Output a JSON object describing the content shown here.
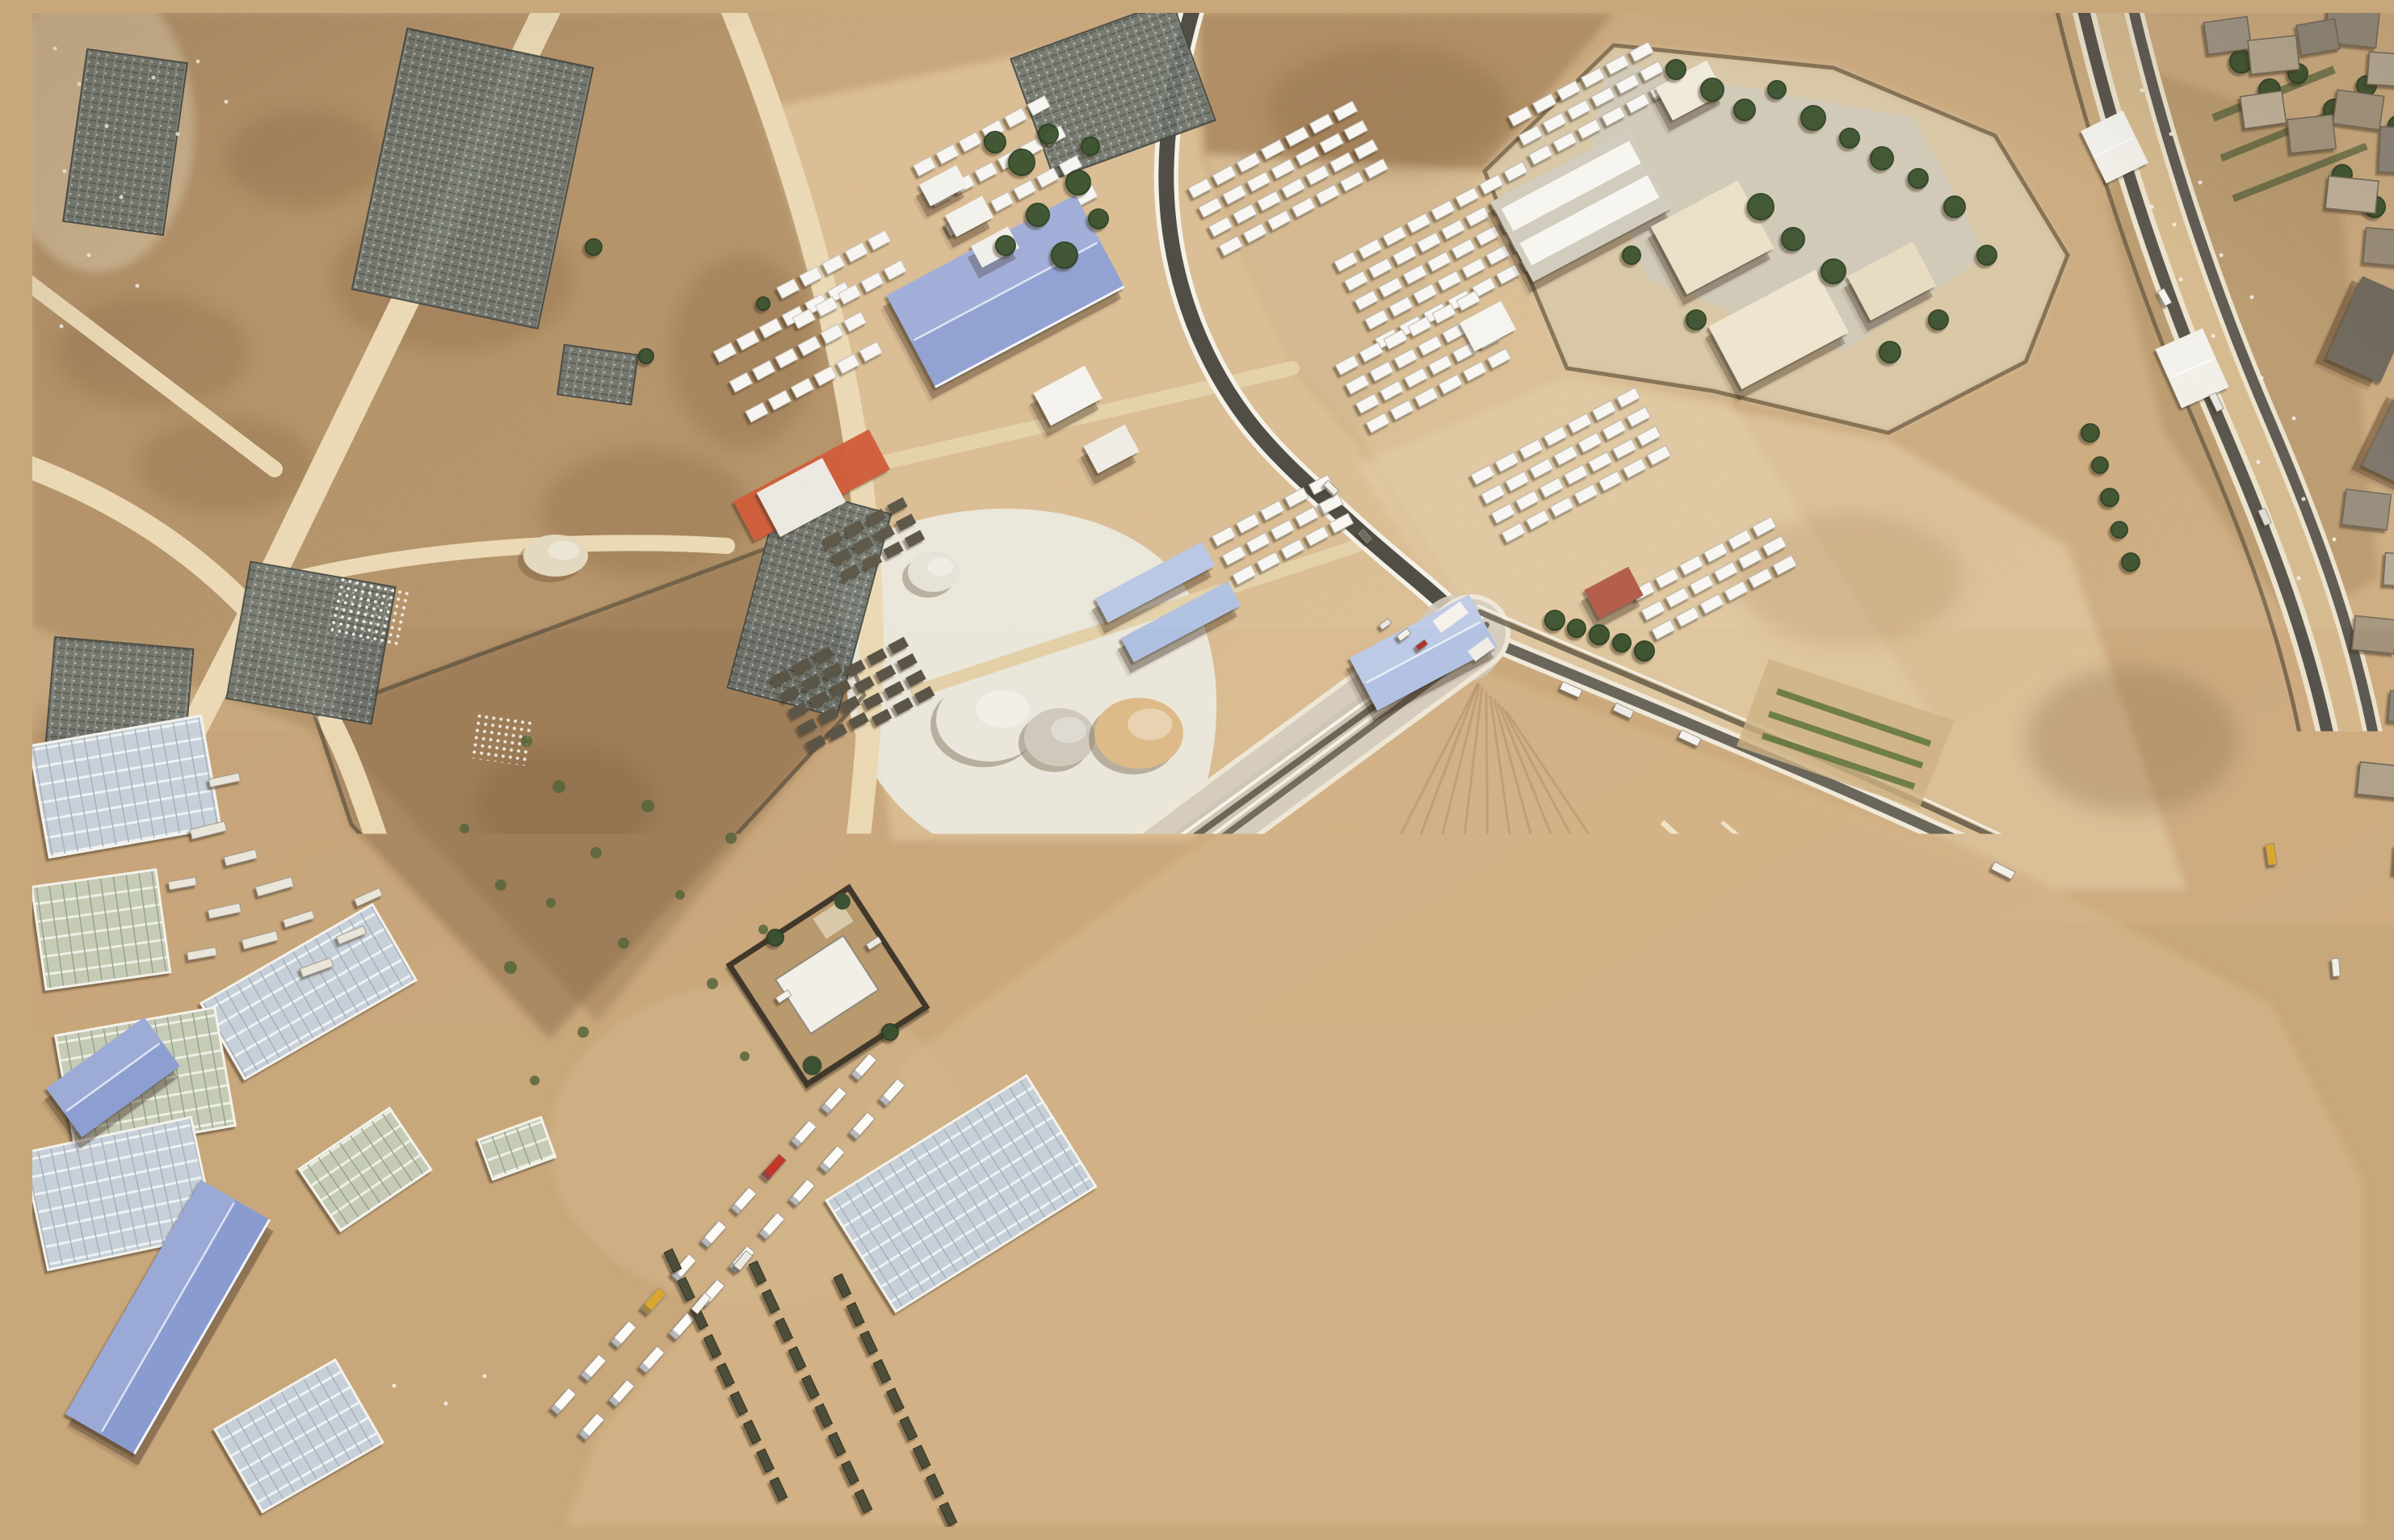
{
  "meta": {
    "type": "satellite-aerial-photograph",
    "description": "Overhead satellite view of a desert border-crossing area: a walled logistics compound with tent rows and warehouses, a long queue of aid trucks on a walled road, a crossing facility with trees, a double border road beside a town strip, greenhouses, and terraced earthworks."
  },
  "palette": {
    "sand_base": "#c9a87c",
    "sand_light": "#dcc096",
    "sand_pale": "#e9d9b8",
    "scrub_brown": "#9d7c57",
    "field_dark": "#8a6a49",
    "road_sand": "#ead8b2",
    "asphalt": "#4d4a43",
    "white_line": "#f4f1e8",
    "gravel": "#ece9e0",
    "roof_white": "#f5f4f0",
    "blue_roof": "#8d9ed1",
    "blue_glass": "#b7c6e4",
    "tree_green": "#3a5130",
    "red_tarp": "#d05a38",
    "truck_white": "#fbfaf7",
    "olive_vehicle": "#4e4e3a",
    "pad_gray": "#b5b0a5"
  },
  "scene": {
    "buildings": [
      [
        "blue-warehouse-main",
        1205,
        345,
        265,
        130,
        -28,
        "#8d9ed1",
        "srh"
      ],
      [
        "blue-shed-a",
        1390,
        705,
        150,
        34,
        -28,
        "#b7c6e4",
        "s"
      ],
      [
        "blue-shed-b",
        1422,
        754,
        150,
        34,
        -28,
        "#aebfe0",
        "s"
      ],
      [
        "blue-shed-east",
        1722,
        792,
        168,
        74,
        -28,
        "#b3c2e2",
        "sr"
      ],
      [
        "blue-building-small-sw",
        100,
        1318,
        150,
        75,
        -36,
        "#8d9ed1",
        "sr"
      ],
      [
        "blue-warehouse-sw",
        168,
        1615,
        335,
        100,
        -60,
        "#8a9bd0",
        "srh"
      ],
      [
        "facility-main-hall",
        1918,
        238,
        195,
        112,
        -28,
        "#f3f1ea",
        "s2"
      ],
      [
        "facility-annex-a",
        2080,
        278,
        122,
        95,
        -28,
        "#eadfc6",
        "s"
      ],
      [
        "facility-annex-b",
        2162,
        392,
        150,
        88,
        -28,
        "#eee4cf",
        "s"
      ],
      [
        "facility-north-building",
        2052,
        96,
        72,
        46,
        -28,
        "#efe9d8",
        "s"
      ],
      [
        "facility-east-building",
        2302,
        332,
        92,
        62,
        -28,
        "#e6dac0",
        "s"
      ],
      [
        "facility-gate-canopy",
        1802,
        388,
        58,
        40,
        -28,
        "#f6f4ee",
        ""
      ],
      [
        "red-roof-house",
        1958,
        718,
        62,
        40,
        -28,
        "#b05a4a",
        "s"
      ],
      [
        "junction-gate-a",
        1756,
        748,
        42,
        18,
        -36,
        "#f4f2ea",
        ""
      ],
      [
        "junction-gate-b",
        1794,
        788,
        30,
        16,
        -36,
        "#efede5",
        ""
      ],
      [
        "median-tent-a",
        2578,
        166,
        58,
        72,
        -26,
        "#f3f1ea",
        "r"
      ],
      [
        "median-tent-b",
        2674,
        440,
        64,
        80,
        -24,
        "#f1efe8",
        "r"
      ],
      [
        "white-shed-a",
        1282,
        474,
        72,
        46,
        -28,
        "#f4f3ee",
        "s"
      ],
      [
        "white-shed-b",
        1336,
        540,
        58,
        38,
        -28,
        "#eeece4",
        "s"
      ],
      [
        "white-pad-shed",
        952,
        600,
        92,
        62,
        -28,
        "#ebe8df",
        ""
      ],
      [
        "compound-shed-1",
        1128,
        214,
        52,
        30,
        -28,
        "#f2f1ec",
        "s"
      ],
      [
        "compound-shed-2",
        1160,
        252,
        52,
        30,
        -28,
        "#f2f1ec",
        "s"
      ],
      [
        "compound-shed-3",
        1192,
        290,
        52,
        30,
        -28,
        "#f0efe9",
        "s"
      ],
      [
        "town-warehouse-a",
        2896,
        392,
        74,
        112,
        24,
        "#6e675c",
        "s"
      ],
      [
        "town-warehouse-b",
        2936,
        530,
        66,
        100,
        26,
        "#7a7268",
        "s"
      ]
    ],
    "truck_queues": [
      {
        "p0": [
          1742,
          802
        ],
        "p1": [
          985,
          1358
        ],
        "lanes": [
          -16,
          15
        ],
        "count": 23,
        "w": 37,
        "h": 13,
        "rot": -36.4,
        "cab_colors": {
          "2": "#c0392b",
          "6": "#d9a62e",
          "9": "#3f7d3f",
          "13": "#b03030",
          "17": "#2e5fa3",
          "20": "#c0392b"
        }
      },
      {
        "p0": [
          1048,
          1322
        ],
        "p1": [
          676,
          1736
        ],
        "lanes": [
          -22,
          25
        ],
        "count": 11,
        "w": 34,
        "h": 12,
        "rot": -48.3,
        "cab_colors": {
          "3": "#c0392b",
          "7": "#d9a62e"
        }
      }
    ],
    "military_rows": {
      "starts": [
        [
          793,
          1545
        ],
        [
          898,
          1560
        ],
        [
          1003,
          1576
        ]
      ],
      "dir": [
        0.42,
        0.907
      ],
      "spacing": 39,
      "count": 9,
      "w": 27,
      "h": 11,
      "rot": 65,
      "fill": "#4e4e3a"
    },
    "container_blocks": [
      [
        1555,
        205,
        -28,
        4,
        7
      ],
      [
        1757,
        300,
        -28,
        5,
        8
      ],
      [
        1722,
        432,
        -28,
        4,
        6
      ],
      [
        1905,
        560,
        -28,
        4,
        7
      ],
      [
        2082,
        700,
        -28,
        3,
        6
      ],
      [
        1548,
        640,
        -28,
        3,
        5
      ],
      [
        1930,
        112,
        -28,
        3,
        6
      ]
    ],
    "tent_blocks": [
      [
        1205,
        208,
        -28,
        4,
        6
      ],
      [
        948,
        420,
        -28,
        3,
        6
      ],
      [
        1002,
        330,
        -28,
        2,
        5
      ]
    ],
    "pallet_blocks": [
      [
        975,
        850,
        -28,
        5,
        3
      ],
      [
        1062,
        828,
        -28,
        4,
        3
      ],
      [
        1042,
        652,
        -28,
        3,
        4
      ]
    ],
    "greenhouses": [
      [
        115,
        958,
        215,
        140,
        -10,
        0
      ],
      [
        85,
        1135,
        155,
        128,
        -8,
        1
      ],
      [
        342,
        1212,
        245,
        108,
        -30,
        0
      ],
      [
        140,
        1322,
        200,
        148,
        -10,
        1
      ],
      [
        108,
        1462,
        212,
        148,
        -12,
        0
      ],
      [
        412,
        1432,
        135,
        92,
        -34,
        1
      ],
      [
        1150,
        1462,
        292,
        162,
        -32,
        0
      ],
      [
        600,
        1406,
        82,
        52,
        -20,
        1
      ],
      [
        330,
        1762,
        172,
        118,
        -30,
        0
      ]
    ],
    "ruined_greenhouses": [
      [
        115,
        160,
        125,
        215,
        8
      ],
      [
        545,
        205,
        235,
        330,
        12
      ],
      [
        1338,
        95,
        212,
        158,
        -20
      ],
      [
        345,
        780,
        182,
        172,
        10
      ],
      [
        105,
        880,
        172,
        200,
        5
      ],
      [
        962,
        728,
        140,
        260,
        15
      ],
      [
        700,
        448,
        92,
        62,
        8
      ],
      [
        268,
        1108,
        70,
        85,
        0
      ]
    ],
    "dot_grids": [
      [
        418,
        742,
        88,
        76,
        12
      ],
      [
        582,
        898,
        72,
        60,
        8
      ]
    ],
    "piles": [
      [
        1185,
        875,
        66,
        52,
        "#eae6dc"
      ],
      [
        1272,
        897,
        44,
        36,
        "#cfc8bb"
      ],
      [
        1370,
        892,
        55,
        44,
        "#ddba88"
      ],
      [
        1116,
        692,
        32,
        25,
        "#e5e1d6"
      ],
      [
        648,
        672,
        40,
        26,
        "#e2d7bd"
      ]
    ],
    "stacks": [
      [
        218,
        1012,
        44,
        12,
        -14
      ],
      [
        258,
        1046,
        40,
        11,
        -14
      ],
      [
        300,
        1082,
        46,
        12,
        -16
      ],
      [
        238,
        1112,
        40,
        11,
        -12
      ],
      [
        282,
        1148,
        44,
        12,
        -15
      ],
      [
        330,
        1122,
        38,
        10,
        -18
      ],
      [
        210,
        1165,
        36,
        10,
        -10
      ],
      [
        352,
        1182,
        40,
        11,
        -20
      ],
      [
        395,
        1142,
        36,
        10,
        -22
      ],
      [
        416,
        1095,
        34,
        10,
        -24
      ],
      [
        238,
        950,
        38,
        10,
        -12
      ],
      [
        186,
        1078,
        34,
        10,
        -10
      ]
    ],
    "trees": [
      [
        1192,
        160,
        13
      ],
      [
        1225,
        185,
        16
      ],
      [
        1258,
        150,
        12
      ],
      [
        1295,
        210,
        15
      ],
      [
        1310,
        165,
        11
      ],
      [
        1245,
        250,
        14
      ],
      [
        1205,
        288,
        12
      ],
      [
        1278,
        300,
        16
      ],
      [
        1320,
        255,
        12
      ],
      [
        2035,
        70,
        12
      ],
      [
        2080,
        95,
        14
      ],
      [
        2120,
        120,
        13
      ],
      [
        2160,
        95,
        11
      ],
      [
        2205,
        130,
        15
      ],
      [
        2250,
        155,
        12
      ],
      [
        2290,
        180,
        14
      ],
      [
        2335,
        205,
        12
      ],
      [
        2140,
        240,
        16
      ],
      [
        2180,
        280,
        14
      ],
      [
        2230,
        320,
        15
      ],
      [
        2380,
        240,
        13
      ],
      [
        2420,
        300,
        12
      ],
      [
        2300,
        420,
        13
      ],
      [
        2360,
        380,
        12
      ],
      [
        2060,
        380,
        12
      ],
      [
        1980,
        300,
        11
      ],
      [
        1885,
        752,
        12
      ],
      [
        1912,
        762,
        11
      ],
      [
        1940,
        770,
        12
      ],
      [
        1968,
        780,
        11
      ],
      [
        1996,
        790,
        12
      ],
      [
        2548,
        520,
        11
      ],
      [
        2560,
        560,
        10
      ],
      [
        2572,
        600,
        11
      ],
      [
        2584,
        640,
        10
      ],
      [
        2598,
        680,
        11
      ],
      [
        695,
        290,
        10
      ],
      [
        760,
        425,
        9
      ],
      [
        905,
        360,
        8
      ],
      [
        2735,
        60,
        14
      ],
      [
        2770,
        95,
        13
      ],
      [
        2805,
        75,
        12
      ],
      [
        2850,
        120,
        13
      ],
      [
        2890,
        90,
        12
      ],
      [
        2930,
        140,
        13
      ],
      [
        2958,
        200,
        12
      ],
      [
        2900,
        240,
        13
      ],
      [
        2860,
        200,
        12
      ],
      [
        920,
        1145,
        10
      ],
      [
        1062,
        1262,
        10
      ]
    ],
    "shrubs": [
      [
        612,
        902,
        7
      ],
      [
        652,
        958,
        8
      ],
      [
        698,
        1040,
        7
      ],
      [
        642,
        1102,
        6
      ],
      [
        592,
        1182,
        8
      ],
      [
        732,
        1152,
        7
      ],
      [
        802,
        1092,
        6
      ],
      [
        762,
        982,
        8
      ],
      [
        682,
        1262,
        7
      ],
      [
        622,
        1322,
        6
      ],
      [
        842,
        1202,
        7
      ],
      [
        882,
        1292,
        6
      ],
      [
        535,
        1010,
        6
      ],
      [
        580,
        1080,
        7
      ],
      [
        905,
        1135,
        6
      ],
      [
        865,
        1022,
        7
      ]
    ],
    "vehicles": [
      [
        1698,
        770,
        16,
        8,
        -36,
        "#f4f2ec"
      ],
      [
        1720,
        783,
        14,
        7,
        -36,
        "#b03030"
      ],
      [
        1675,
        757,
        14,
        7,
        -36,
        "#e8e6de"
      ],
      [
        1905,
        838,
        26,
        10,
        24,
        "#f6f4ee"
      ],
      [
        1970,
        864,
        24,
        10,
        25,
        "#eceae2"
      ],
      [
        2052,
        898,
        26,
        10,
        25,
        "#f6f4ee"
      ],
      [
        2440,
        1062,
        28,
        10,
        27,
        "#f2f0e8"
      ],
      [
        2640,
        352,
        20,
        9,
        62,
        "#f5f3ee"
      ],
      [
        2704,
        482,
        22,
        9,
        64,
        "#e8e6e0"
      ],
      [
        2764,
        624,
        20,
        9,
        66,
        "#dddbd2"
      ],
      [
        2772,
        1042,
        26,
        11,
        82,
        "#d9a62e"
      ],
      [
        2852,
        1182,
        22,
        9,
        85,
        "#f0eee8"
      ],
      [
        1608,
        588,
        18,
        8,
        44,
        "#f2f0e8"
      ],
      [
        1650,
        648,
        16,
        8,
        48,
        "#6a675f"
      ],
      [
        930,
        1218,
        18,
        8,
        -33,
        "#f4f2ec"
      ],
      [
        1042,
        1152,
        18,
        8,
        -33,
        "#eceae2"
      ],
      [
        828,
        1598,
        26,
        10,
        -50,
        "#f6f4ee"
      ],
      [
        880,
        1545,
        24,
        10,
        -50,
        "#eceae2"
      ]
    ],
    "town_blocks": [
      [
        2872,
        18,
        64,
        44,
        6,
        "#8f8678"
      ],
      [
        2918,
        70,
        52,
        40,
        4,
        "#b5a892"
      ],
      [
        2880,
        120,
        58,
        42,
        8,
        "#a3937c"
      ],
      [
        2930,
        170,
        48,
        56,
        3,
        "#8a8274"
      ],
      [
        2872,
        225,
        62,
        40,
        6,
        "#c0b098"
      ],
      [
        2915,
        290,
        55,
        44,
        5,
        "#998b76"
      ],
      [
        2890,
        615,
        56,
        44,
        7,
        "#948a7a"
      ],
      [
        2935,
        690,
        46,
        40,
        4,
        "#b5a892"
      ],
      [
        2900,
        770,
        52,
        42,
        6,
        "#a3937c"
      ],
      [
        2940,
        860,
        44,
        38,
        5,
        "#8f8678"
      ],
      [
        2905,
        950,
        50,
        40,
        6,
        "#b0a28a"
      ],
      [
        2945,
        1050,
        42,
        36,
        4,
        "#a89a82"
      ],
      [
        2718,
        28,
        54,
        40,
        -8,
        "#9c9183"
      ],
      [
        2775,
        52,
        60,
        42,
        -6,
        "#b3a58d"
      ],
      [
        2830,
        30,
        48,
        38,
        -10,
        "#8a8274"
      ],
      [
        2762,
        120,
        52,
        40,
        -8,
        "#c0b098"
      ],
      [
        2822,
        150,
        56,
        42,
        -6,
        "#a3937c"
      ]
    ],
    "fan_lines": [
      [
        1790,
        830,
        1250,
        1885
      ],
      [
        1790,
        830,
        1390,
        1885
      ],
      [
        1792,
        832,
        1530,
        1885
      ],
      [
        1795,
        835,
        1670,
        1885
      ],
      [
        1800,
        840,
        1810,
        1885
      ],
      [
        1805,
        845,
        1950,
        1885
      ],
      [
        1810,
        850,
        2090,
        1885
      ],
      [
        1815,
        855,
        2230,
        1885
      ],
      [
        1820,
        860,
        2370,
        1885
      ],
      [
        1825,
        865,
        2510,
        1885
      ],
      [
        2886,
        1470,
        2300,
        1885
      ],
      [
        2880,
        1540,
        2430,
        1885
      ],
      [
        2874,
        1610,
        2560,
        1885
      ],
      [
        1100,
        1452,
        940,
        1885
      ],
      [
        1160,
        1470,
        1040,
        1885
      ],
      [
        2200,
        1100,
        2886,
        1420
      ]
    ],
    "speckles": [
      [
        2612,
        96
      ],
      [
        2648,
        150
      ],
      [
        2684,
        210
      ],
      [
        2652,
        262
      ],
      [
        2710,
        300
      ],
      [
        2748,
        352
      ],
      [
        2700,
        400
      ],
      [
        2760,
        452
      ],
      [
        2800,
        502
      ],
      [
        2756,
        556
      ],
      [
        2812,
        602
      ],
      [
        2850,
        652
      ],
      [
        2806,
        700
      ],
      [
        2660,
        330
      ],
      [
        2624,
        240
      ],
      [
        28,
        44
      ],
      [
        58,
        88
      ],
      [
        92,
        140
      ],
      [
        40,
        196
      ],
      [
        110,
        228
      ],
      [
        70,
        300
      ],
      [
        130,
        338
      ],
      [
        36,
        388
      ],
      [
        150,
        80
      ],
      [
        180,
        150
      ],
      [
        448,
        1700
      ],
      [
        512,
        1722
      ],
      [
        560,
        1688
      ],
      [
        205,
        60
      ],
      [
        240,
        110
      ]
    ]
  }
}
